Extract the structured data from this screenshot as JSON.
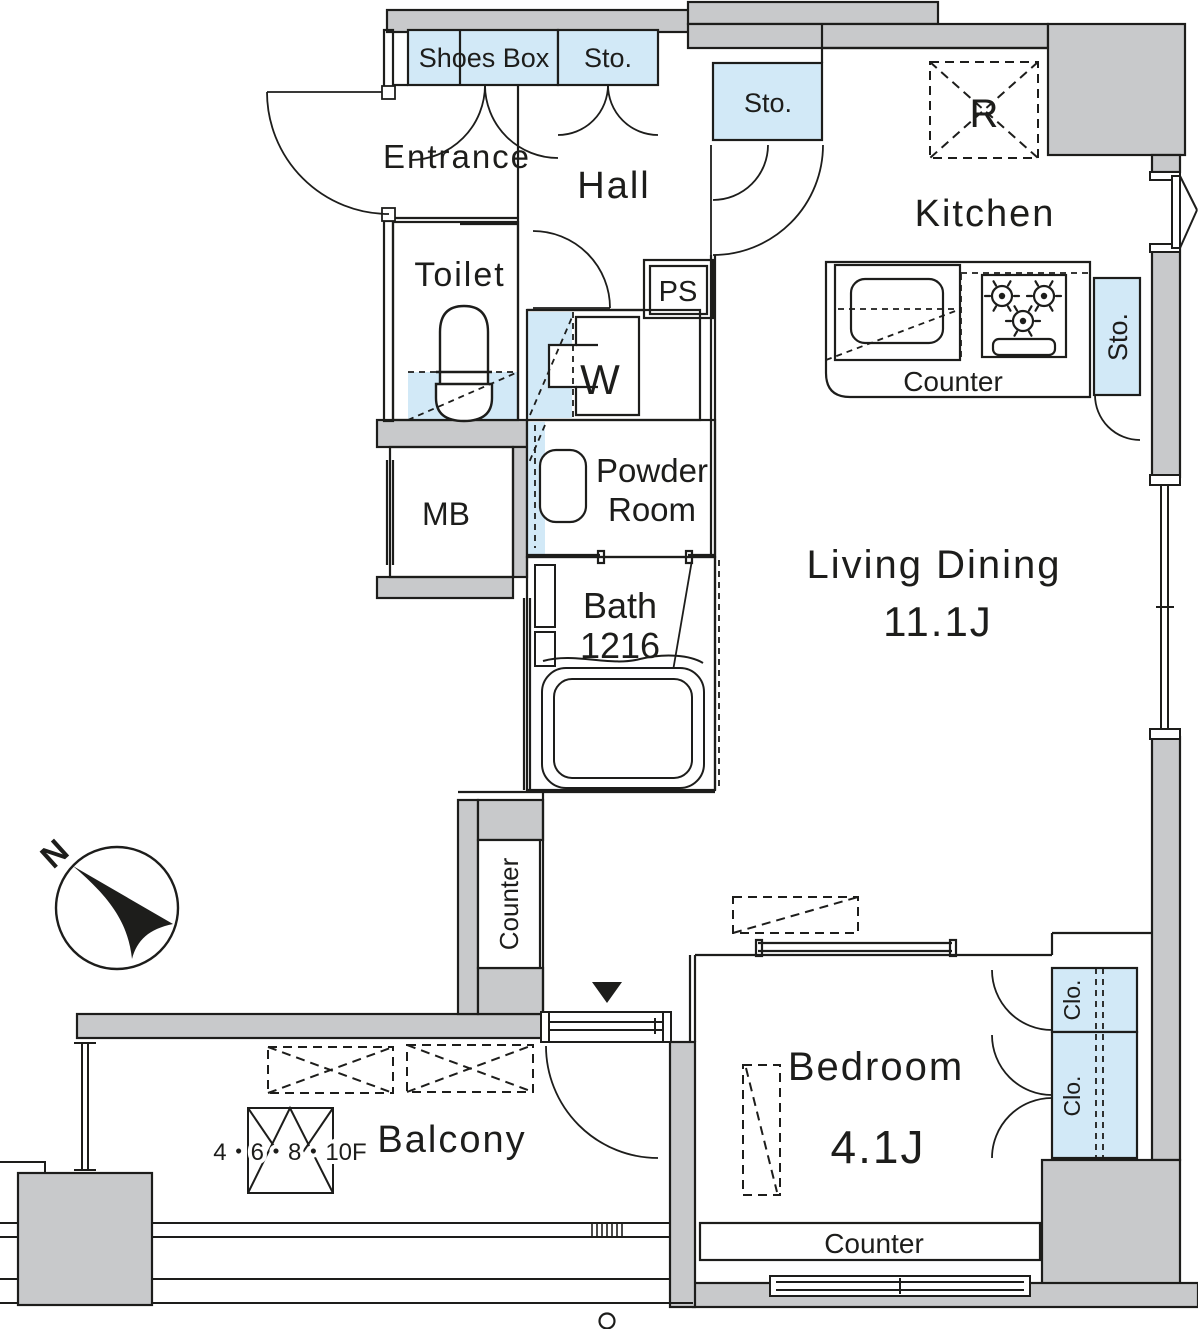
{
  "colors": {
    "wall_fill": "#c8c9cb",
    "storage_fill": "#d2e9f7",
    "line": "#1d1d1b"
  },
  "rooms": {
    "shoes_box": "Shoes Box",
    "sto": "Sto.",
    "entrance": "Entrance",
    "hall": "Hall",
    "toilet": "Toilet",
    "ps": "PS",
    "washer": "W",
    "powder_line1": "Powder",
    "powder_line2": "Room",
    "mb": "MB",
    "bath_line1": "Bath",
    "bath_line2": "1216",
    "kitchen": "Kitchen",
    "refrigerator": "R",
    "counter": "Counter",
    "living_line1": "Living Dining",
    "living_line2": "11.1J",
    "bedroom_line1": "Bedroom",
    "bedroom_line2": "4.1J",
    "closet": "Clo.",
    "balcony": "Balcony",
    "floors_note": "4・6・8・10F",
    "north": "N"
  }
}
